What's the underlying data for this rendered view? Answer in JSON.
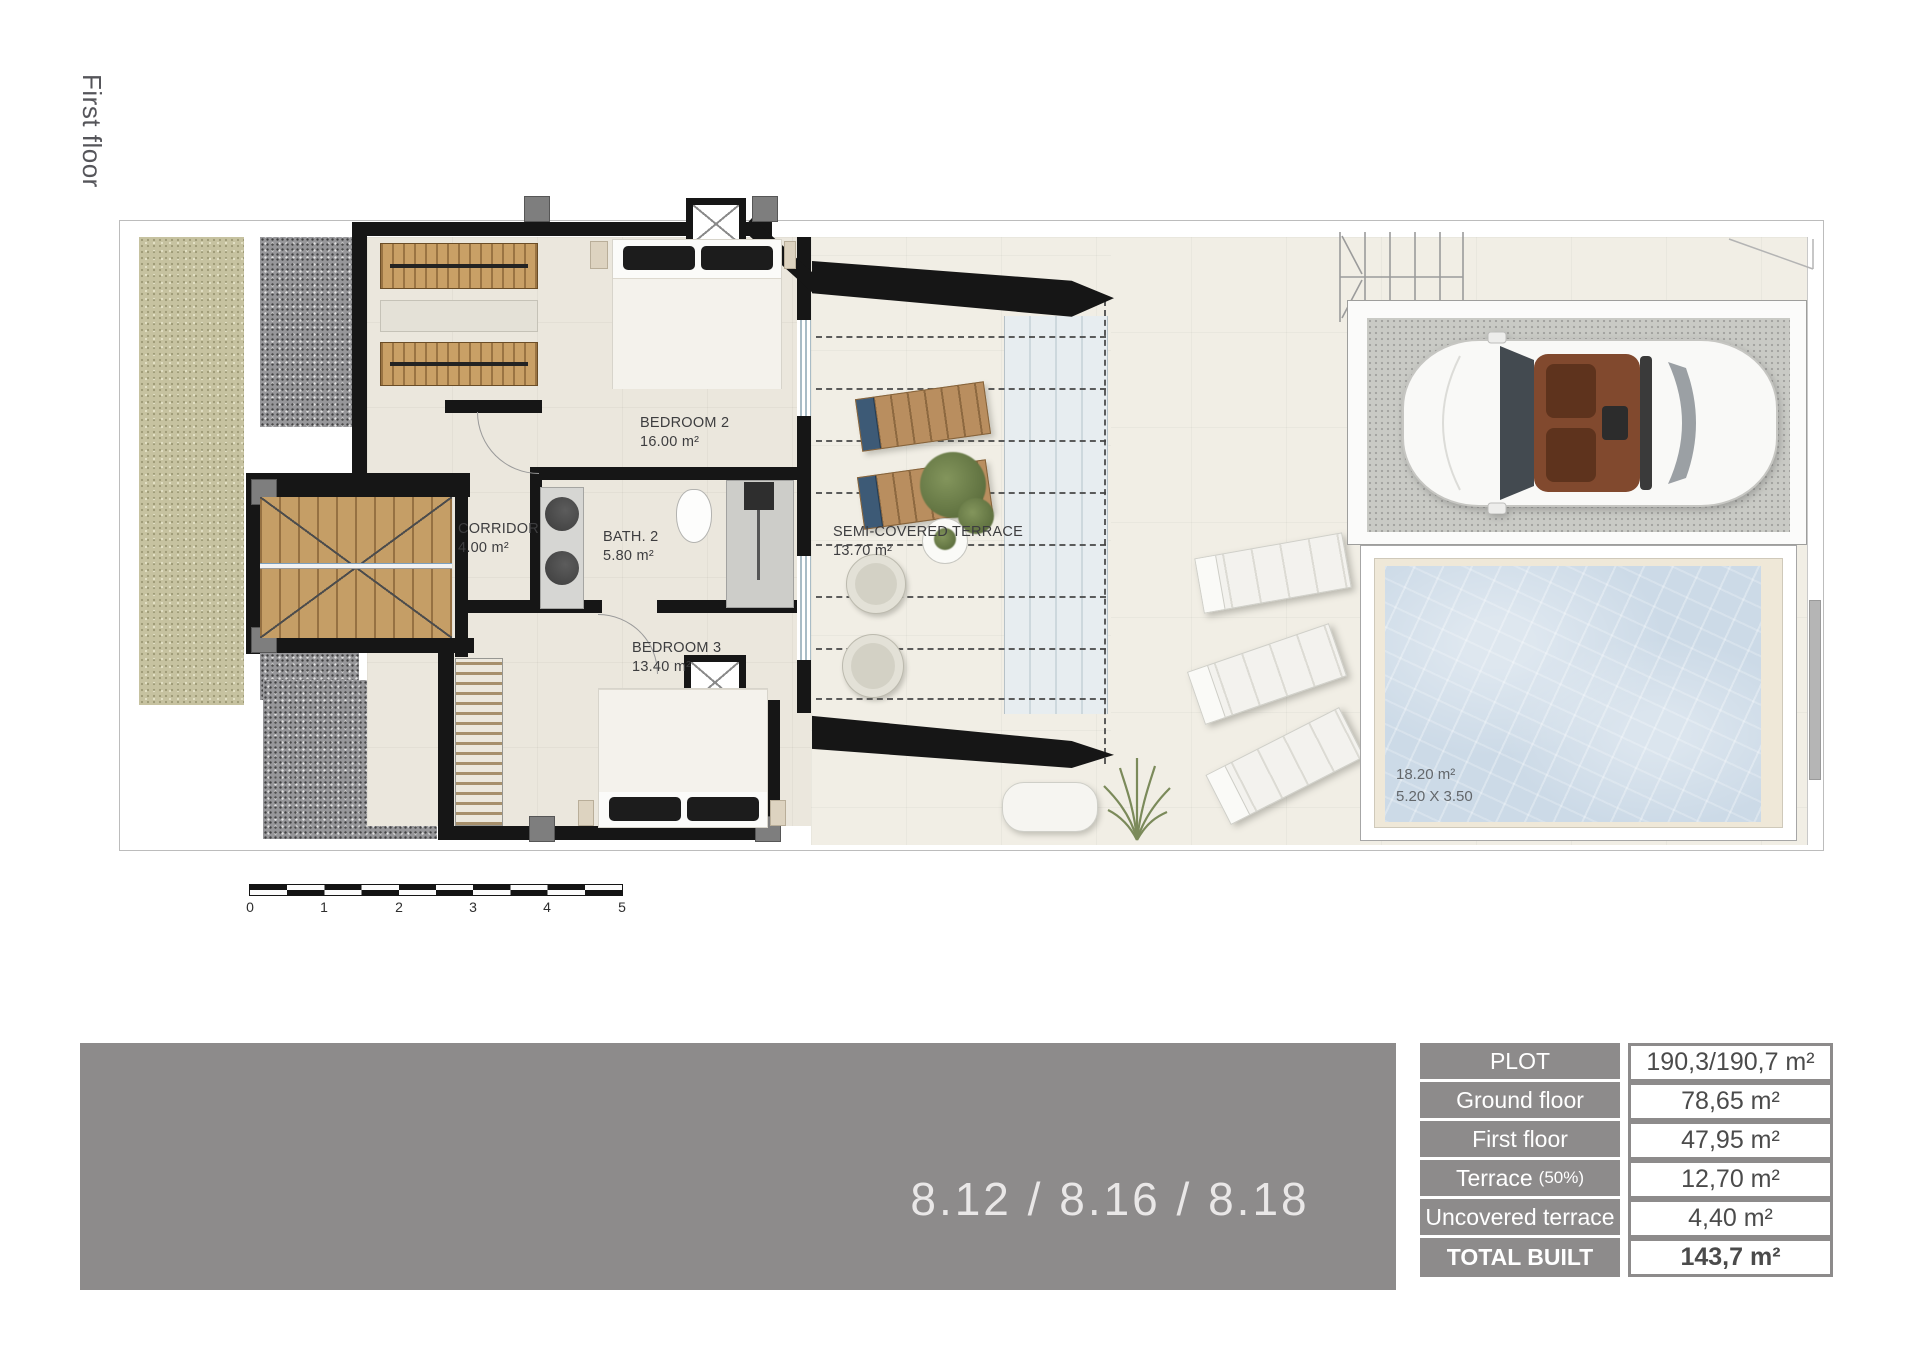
{
  "page": {
    "floor_label": "First floor"
  },
  "plan": {
    "rooms": [
      {
        "name": "BEDROOM 2",
        "area": "16.00 m²"
      },
      {
        "name": "CORRIDOR",
        "area": "4.00 m²"
      },
      {
        "name": "BATH. 2",
        "area": "5.80 m²"
      },
      {
        "name": "BEDROOM 3",
        "area": "13.40 m²"
      },
      {
        "name": "SEMI-COVERED TERRACE",
        "area": "13.70 m²"
      }
    ],
    "pool": {
      "area": "18.20 m²",
      "dimensions": "5.20 X 3.50"
    },
    "scale_bar": {
      "ticks": [
        "0",
        "1",
        "2",
        "3",
        "4",
        "5"
      ]
    }
  },
  "footer": {
    "unit_numbers": "8.12 / 8.16 / 8.18",
    "areas_table": {
      "rows": [
        {
          "label": "PLOT",
          "value": "190,3/190,7 m²"
        },
        {
          "label": "Ground floor",
          "value": "78,65 m²"
        },
        {
          "label": "First floor",
          "value": "47,95 m²"
        },
        {
          "label": "Terrace",
          "label_suffix": "(50%)",
          "value": "12,70 m²"
        },
        {
          "label": "Uncovered terrace",
          "value": "4,40 m²"
        },
        {
          "label": "TOTAL BUILT",
          "value": "143,7 m²"
        }
      ]
    }
  },
  "colors": {
    "wall_black": "#161616",
    "banner_gray": "#8d8b8b",
    "pool_blue": "#ccdae7",
    "wood": "#c59e66",
    "garden_green": "#c6c2a0"
  }
}
